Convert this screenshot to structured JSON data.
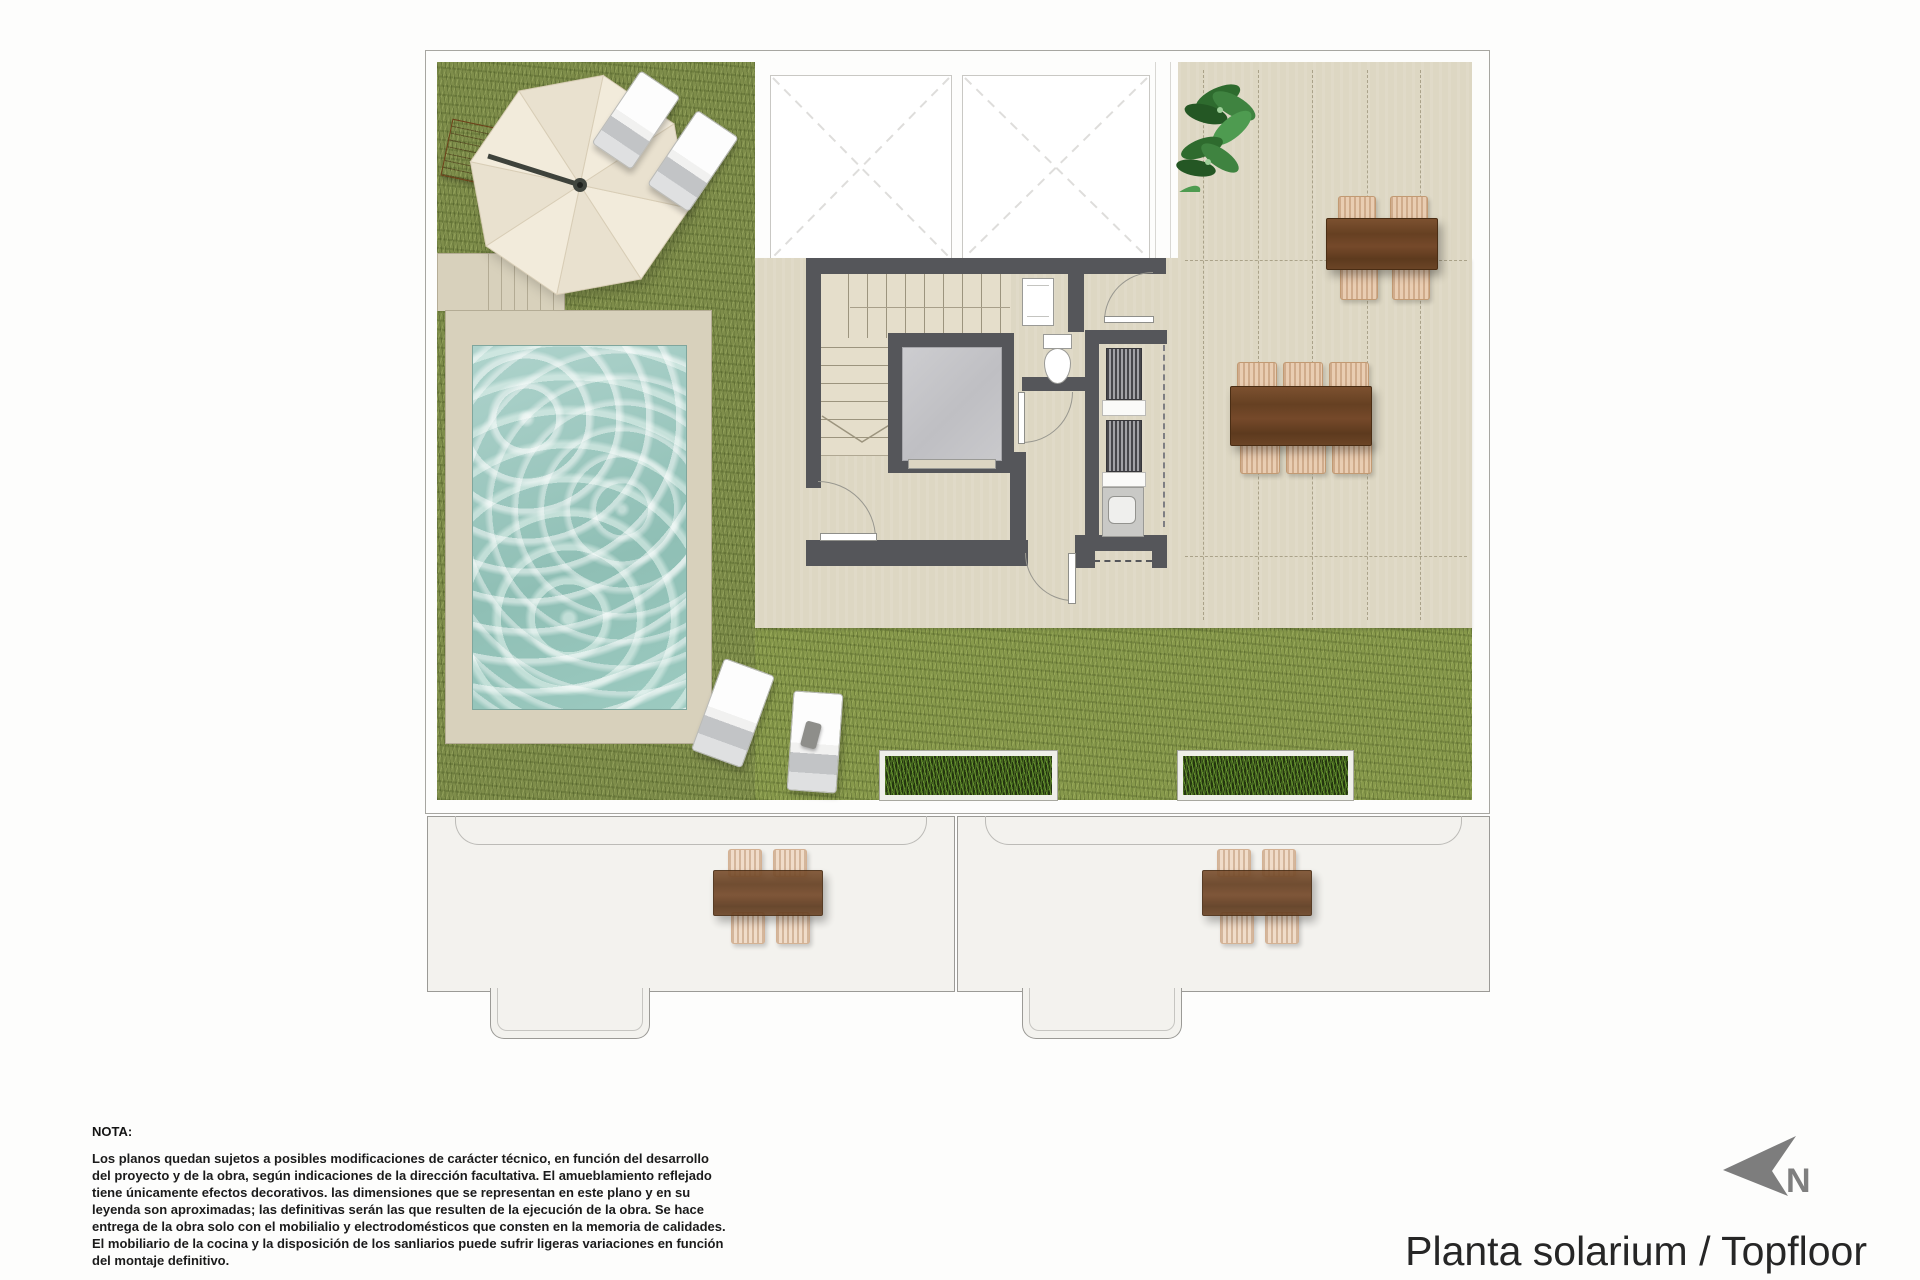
{
  "title": "Planta solarium / Topfloor",
  "north": {
    "label": "N"
  },
  "note": {
    "heading": "NOTA:",
    "lines": [
      "Los planos quedan sujetos a posibles modificaciones de carácter técnico, en función del desarrollo",
      "del proyecto y de la obra, según indicaciones de la dirección facultativa. El amueblamiento reflejado",
      "tiene únicamente efectos decorativos. las dimensiones que se representan en este plano y en su",
      "leyenda son aproximadas; las definitivas serán las que resulten de la ejecución de la obra. Se hace",
      "entrega de la obra solo con el mobilialio y electrodomésticos que consten en la memoria de calidades.",
      "El mobiliario de la cocina y la disposición de los sanliarios puede sufrir ligeras variaciones en función",
      "del montaje definitivo."
    ]
  },
  "plan": {
    "elements": [
      "lawn",
      "swimming-pool",
      "pool-deck",
      "parasol",
      "sun-loungers",
      "skylights",
      "staircase",
      "elevator",
      "toilet",
      "machine-room",
      "outdoor-dining-table-4",
      "outdoor-dining-table-6",
      "planters",
      "tiled-terrace",
      "potted-plant",
      "lower-floor-terraces"
    ],
    "colors": {
      "lawn": "#7e8d4a",
      "lawn_light": "#87994b",
      "terrace": "#ddd7c3",
      "pool_water": "#9fcac2",
      "pool_deck": "#d8d1bc",
      "walls": "#55565a",
      "wood_furniture": "#6f4526",
      "wicker_chairs": "#e9cdb2",
      "background": "#fdfdfc",
      "outline": "#a7a6a1",
      "north_arrow": "#7d7d7d"
    }
  }
}
